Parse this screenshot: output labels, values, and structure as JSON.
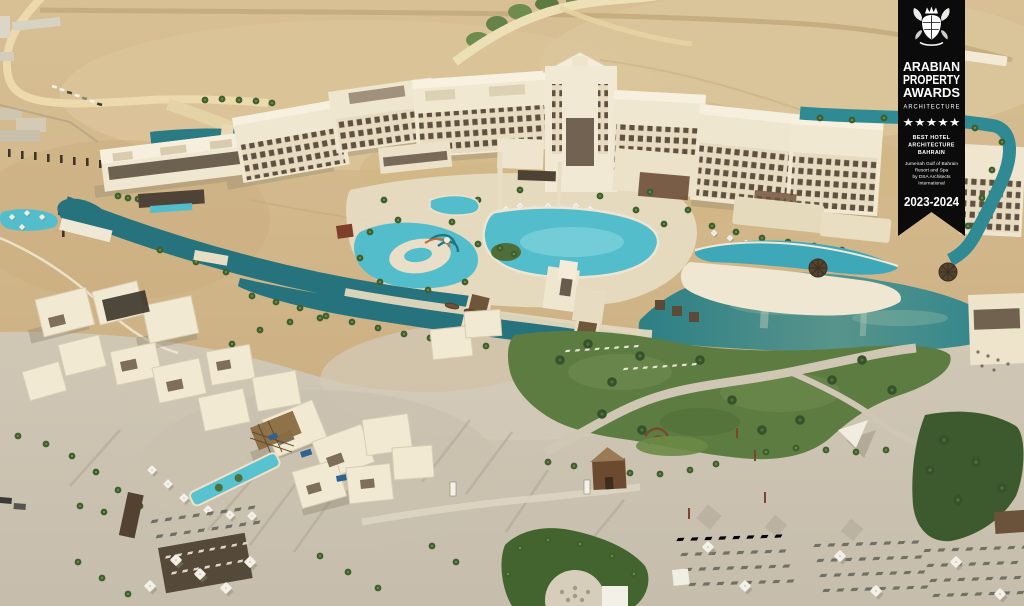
{
  "scene": {
    "description": "Aerial drone photograph of a luxury desert beach resort: a crescent of cream hotel buildings with turquoise pools and a water park, teal lagoons, a villa village, green lawns and a private beach with rows of sun loungers, all surrounded by sand.",
    "palette": {
      "desert_sand": "#d3b98b",
      "beach_sand": "#cbc2b1",
      "building_cream": "#f0e7d1",
      "window_dark": "#5f5040",
      "lagoon_teal": "#26737d",
      "pool_turquoise": "#54bdcc",
      "grass_green": "#5d7c41",
      "palm_green": "#3f5f2e",
      "wood_brown": "#6b523a"
    }
  },
  "award_banner": {
    "background": "#0b0b0b",
    "text_color": "#ffffff",
    "crest_icon": "heraldic-crest",
    "title_lines": [
      "ARABIAN",
      "PROPERTY",
      "AWARDS"
    ],
    "subtitle": "ARCHITECTURE",
    "stars": "★★★★★",
    "category_lines": [
      "BEST HOTEL",
      "ARCHITECTURE",
      "BAHRAIN"
    ],
    "recipient_lines": [
      "Jumeirah Gulf of Bahrain",
      "Resort and Spa",
      "by DSA Architects",
      "International"
    ],
    "edition": "2023-2024"
  }
}
